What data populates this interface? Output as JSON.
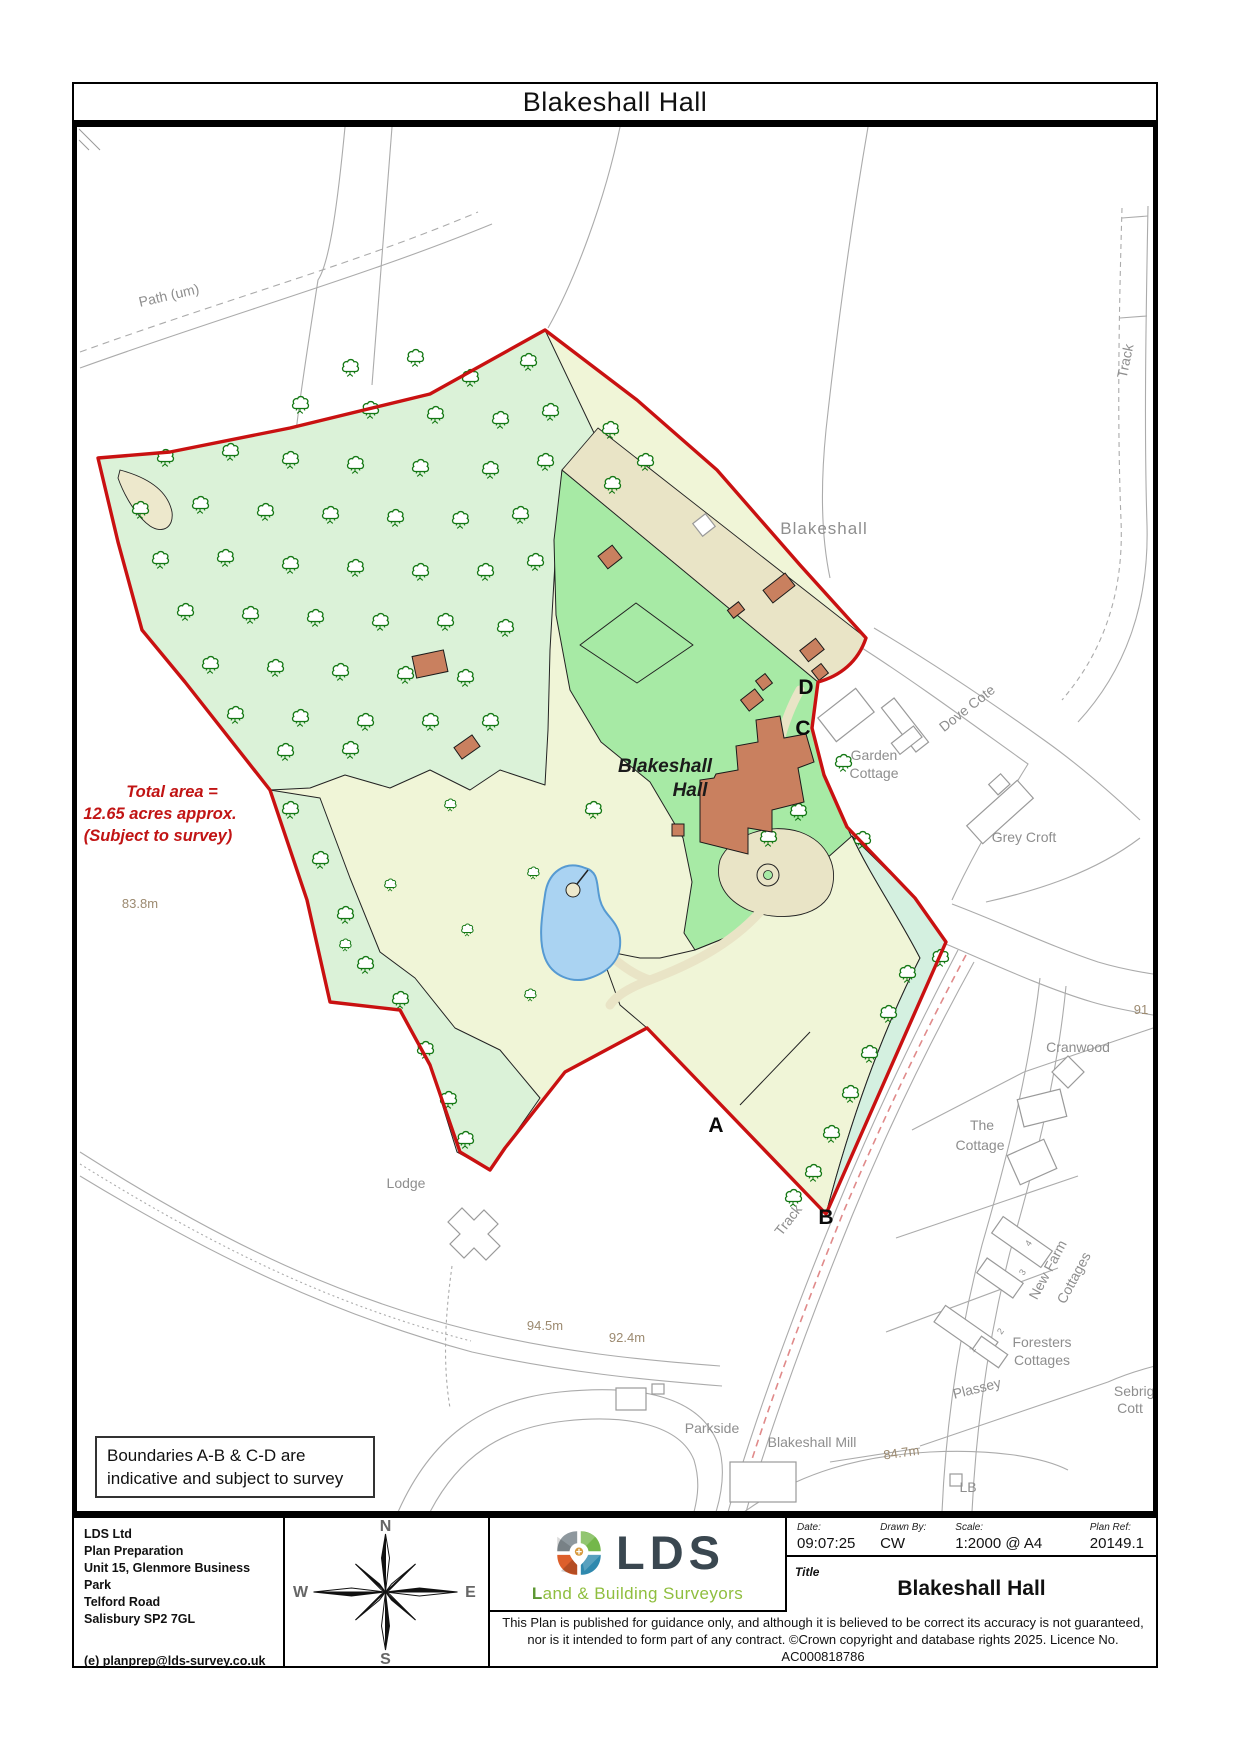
{
  "page": {
    "title": "Blakeshall Hall"
  },
  "map": {
    "annotation": {
      "line1": "Total area =",
      "line2": "12.65 acres approx.",
      "line3": "(Subject to survey)"
    },
    "note_box": {
      "line1": "Boundaries A-B & C-D are",
      "line2": "indicative and subject to survey"
    },
    "site_label": {
      "line1": "Blakeshall",
      "line2": "Hall"
    },
    "markers": [
      {
        "letter": "A",
        "x": 716,
        "y": 1132
      },
      {
        "letter": "B",
        "x": 826,
        "y": 1224
      },
      {
        "letter": "C",
        "x": 803,
        "y": 735
      },
      {
        "letter": "D",
        "x": 806,
        "y": 694
      }
    ],
    "labels": [
      {
        "text": "Path (um)",
        "x": 170,
        "y": 300,
        "rot": -13,
        "cls": "place"
      },
      {
        "text": "Track",
        "x": 1130,
        "y": 362,
        "rot": -78,
        "cls": "place"
      },
      {
        "text": "Blakeshall",
        "x": 824,
        "y": 534,
        "rot": 0,
        "cls": "place-lg"
      },
      {
        "text": "Garden",
        "x": 874,
        "y": 760,
        "rot": 0,
        "cls": "place"
      },
      {
        "text": "Cottage",
        "x": 874,
        "y": 778,
        "rot": 0,
        "cls": "place"
      },
      {
        "text": "Dove Cote",
        "x": 970,
        "y": 712,
        "rot": -38,
        "cls": "place"
      },
      {
        "text": "Grey Croft",
        "x": 1024,
        "y": 842,
        "rot": 0,
        "cls": "place"
      },
      {
        "text": "91",
        "x": 1141,
        "y": 1014,
        "rot": 0,
        "cls": "elev"
      },
      {
        "text": "Cranwood",
        "x": 1078,
        "y": 1052,
        "rot": 0,
        "cls": "place"
      },
      {
        "text": "The",
        "x": 982,
        "y": 1130,
        "rot": 0,
        "cls": "place"
      },
      {
        "text": "Cottage",
        "x": 980,
        "y": 1150,
        "rot": 0,
        "cls": "place"
      },
      {
        "text": "New Farm",
        "x": 1052,
        "y": 1272,
        "rot": -62,
        "cls": "place"
      },
      {
        "text": "Cottages",
        "x": 1078,
        "y": 1280,
        "rot": -62,
        "cls": "place"
      },
      {
        "text": "4",
        "x": 1031,
        "y": 1245,
        "rot": -55,
        "cls": "tiny"
      },
      {
        "text": "3",
        "x": 1025,
        "y": 1274,
        "rot": -55,
        "cls": "tiny"
      },
      {
        "text": "2",
        "x": 1003,
        "y": 1333,
        "rot": -55,
        "cls": "tiny"
      },
      {
        "text": "1",
        "x": 975,
        "y": 1351,
        "rot": -55,
        "cls": "tiny"
      },
      {
        "text": "Foresters",
        "x": 1042,
        "y": 1347,
        "rot": 0,
        "cls": "place"
      },
      {
        "text": "Cottages",
        "x": 1042,
        "y": 1365,
        "rot": 0,
        "cls": "place"
      },
      {
        "text": "Plassey",
        "x": 978,
        "y": 1393,
        "rot": -14,
        "cls": "place"
      },
      {
        "text": "Sebright",
        "x": 1140,
        "y": 1396,
        "rot": 0,
        "cls": "place"
      },
      {
        "text": "Cott",
        "x": 1130,
        "y": 1413,
        "rot": 0,
        "cls": "place"
      },
      {
        "text": "Blakeshall Mill",
        "x": 812,
        "y": 1447,
        "rot": 0,
        "cls": "place"
      },
      {
        "text": "Parkside",
        "x": 712,
        "y": 1433,
        "rot": 0,
        "cls": "place"
      },
      {
        "text": "Lodge",
        "x": 406,
        "y": 1188,
        "rot": 0,
        "cls": "place"
      },
      {
        "text": "Track",
        "x": 792,
        "y": 1223,
        "rot": -52,
        "cls": "place"
      },
      {
        "text": "LB",
        "x": 968,
        "y": 1492,
        "rot": 0,
        "cls": "place"
      },
      {
        "text": "83.8m",
        "x": 140,
        "y": 908,
        "rot": 0,
        "cls": "elev"
      },
      {
        "text": "94.5m",
        "x": 545,
        "y": 1330,
        "rot": 0,
        "cls": "elev"
      },
      {
        "text": "92.4m",
        "x": 627,
        "y": 1342,
        "rot": 0,
        "cls": "elev"
      },
      {
        "text": "84.7m",
        "x": 902,
        "y": 1457,
        "rot": -8,
        "cls": "elev"
      }
    ],
    "trees": {
      "woods": [
        [
          350,
          368
        ],
        [
          415,
          358
        ],
        [
          470,
          378
        ],
        [
          528,
          362
        ],
        [
          610,
          430
        ],
        [
          645,
          462
        ],
        [
          612,
          485
        ],
        [
          300,
          405
        ],
        [
          370,
          410
        ],
        [
          435,
          415
        ],
        [
          500,
          420
        ],
        [
          550,
          412
        ],
        [
          165,
          458
        ],
        [
          230,
          452
        ],
        [
          290,
          460
        ],
        [
          355,
          465
        ],
        [
          420,
          468
        ],
        [
          490,
          470
        ],
        [
          545,
          462
        ],
        [
          140,
          510
        ],
        [
          200,
          505
        ],
        [
          265,
          512
        ],
        [
          330,
          515
        ],
        [
          395,
          518
        ],
        [
          460,
          520
        ],
        [
          520,
          515
        ],
        [
          160,
          560
        ],
        [
          225,
          558
        ],
        [
          290,
          565
        ],
        [
          355,
          568
        ],
        [
          420,
          572
        ],
        [
          485,
          572
        ],
        [
          535,
          562
        ],
        [
          185,
          612
        ],
        [
          250,
          615
        ],
        [
          315,
          618
        ],
        [
          380,
          622
        ],
        [
          445,
          622
        ],
        [
          505,
          628
        ],
        [
          210,
          665
        ],
        [
          275,
          668
        ],
        [
          340,
          672
        ],
        [
          405,
          675
        ],
        [
          465,
          678
        ],
        [
          235,
          715
        ],
        [
          300,
          718
        ],
        [
          365,
          722
        ],
        [
          430,
          722
        ],
        [
          490,
          722
        ],
        [
          285,
          752
        ],
        [
          350,
          750
        ]
      ],
      "strip_w": [
        [
          290,
          810
        ],
        [
          320,
          860
        ],
        [
          345,
          915
        ],
        [
          365,
          965
        ],
        [
          400,
          1000
        ],
        [
          425,
          1050
        ],
        [
          448,
          1100
        ],
        [
          465,
          1140
        ]
      ],
      "strip_se": [
        [
          940,
          958
        ],
        [
          907,
          974
        ],
        [
          888,
          1014
        ],
        [
          869,
          1054
        ],
        [
          850,
          1094
        ],
        [
          831,
          1134
        ],
        [
          813,
          1173
        ],
        [
          793,
          1198
        ]
      ],
      "lawn": [
        [
          775,
          788
        ],
        [
          798,
          812
        ],
        [
          768,
          838
        ],
        [
          593,
          810
        ],
        [
          843,
          763
        ],
        [
          862,
          840
        ]
      ],
      "park": [
        [
          533,
          873
        ],
        [
          467,
          930
        ],
        [
          530,
          995
        ],
        [
          450,
          805
        ],
        [
          390,
          885
        ],
        [
          345,
          945
        ]
      ]
    }
  },
  "footer": {
    "company": {
      "lines": [
        "LDS Ltd",
        "Plan Preparation",
        "Unit 15, Glenmore Business Park",
        "Telford Road",
        "Salisbury SP2 7GL"
      ],
      "email": "(e) planprep@lds-survey.co.uk"
    },
    "compass": {
      "n": "N",
      "s": "S",
      "e": "E",
      "w": "W"
    },
    "logo": {
      "acronym": "LDS",
      "tagline_initial": "L",
      "tagline_rest": "and & Building Surveyors"
    },
    "fields": {
      "date_label": "Date:",
      "date": "09:07:25",
      "drawn_label": "Drawn By:",
      "drawn": "CW",
      "scale_label": "Scale:",
      "scale": "1:2000 @ A4",
      "ref_label": "Plan Ref:",
      "ref": "20149.1",
      "title_label": "Title",
      "title": "Blakeshall Hall"
    },
    "disclaimer": {
      "line1": "This Plan is published for guidance only, and although it is believed to be correct its accuracy is not guaranteed,",
      "line2": "nor is it intended to form part of any contract. ©Crown copyright and database rights 2025. Licence No. AC000818786"
    }
  }
}
